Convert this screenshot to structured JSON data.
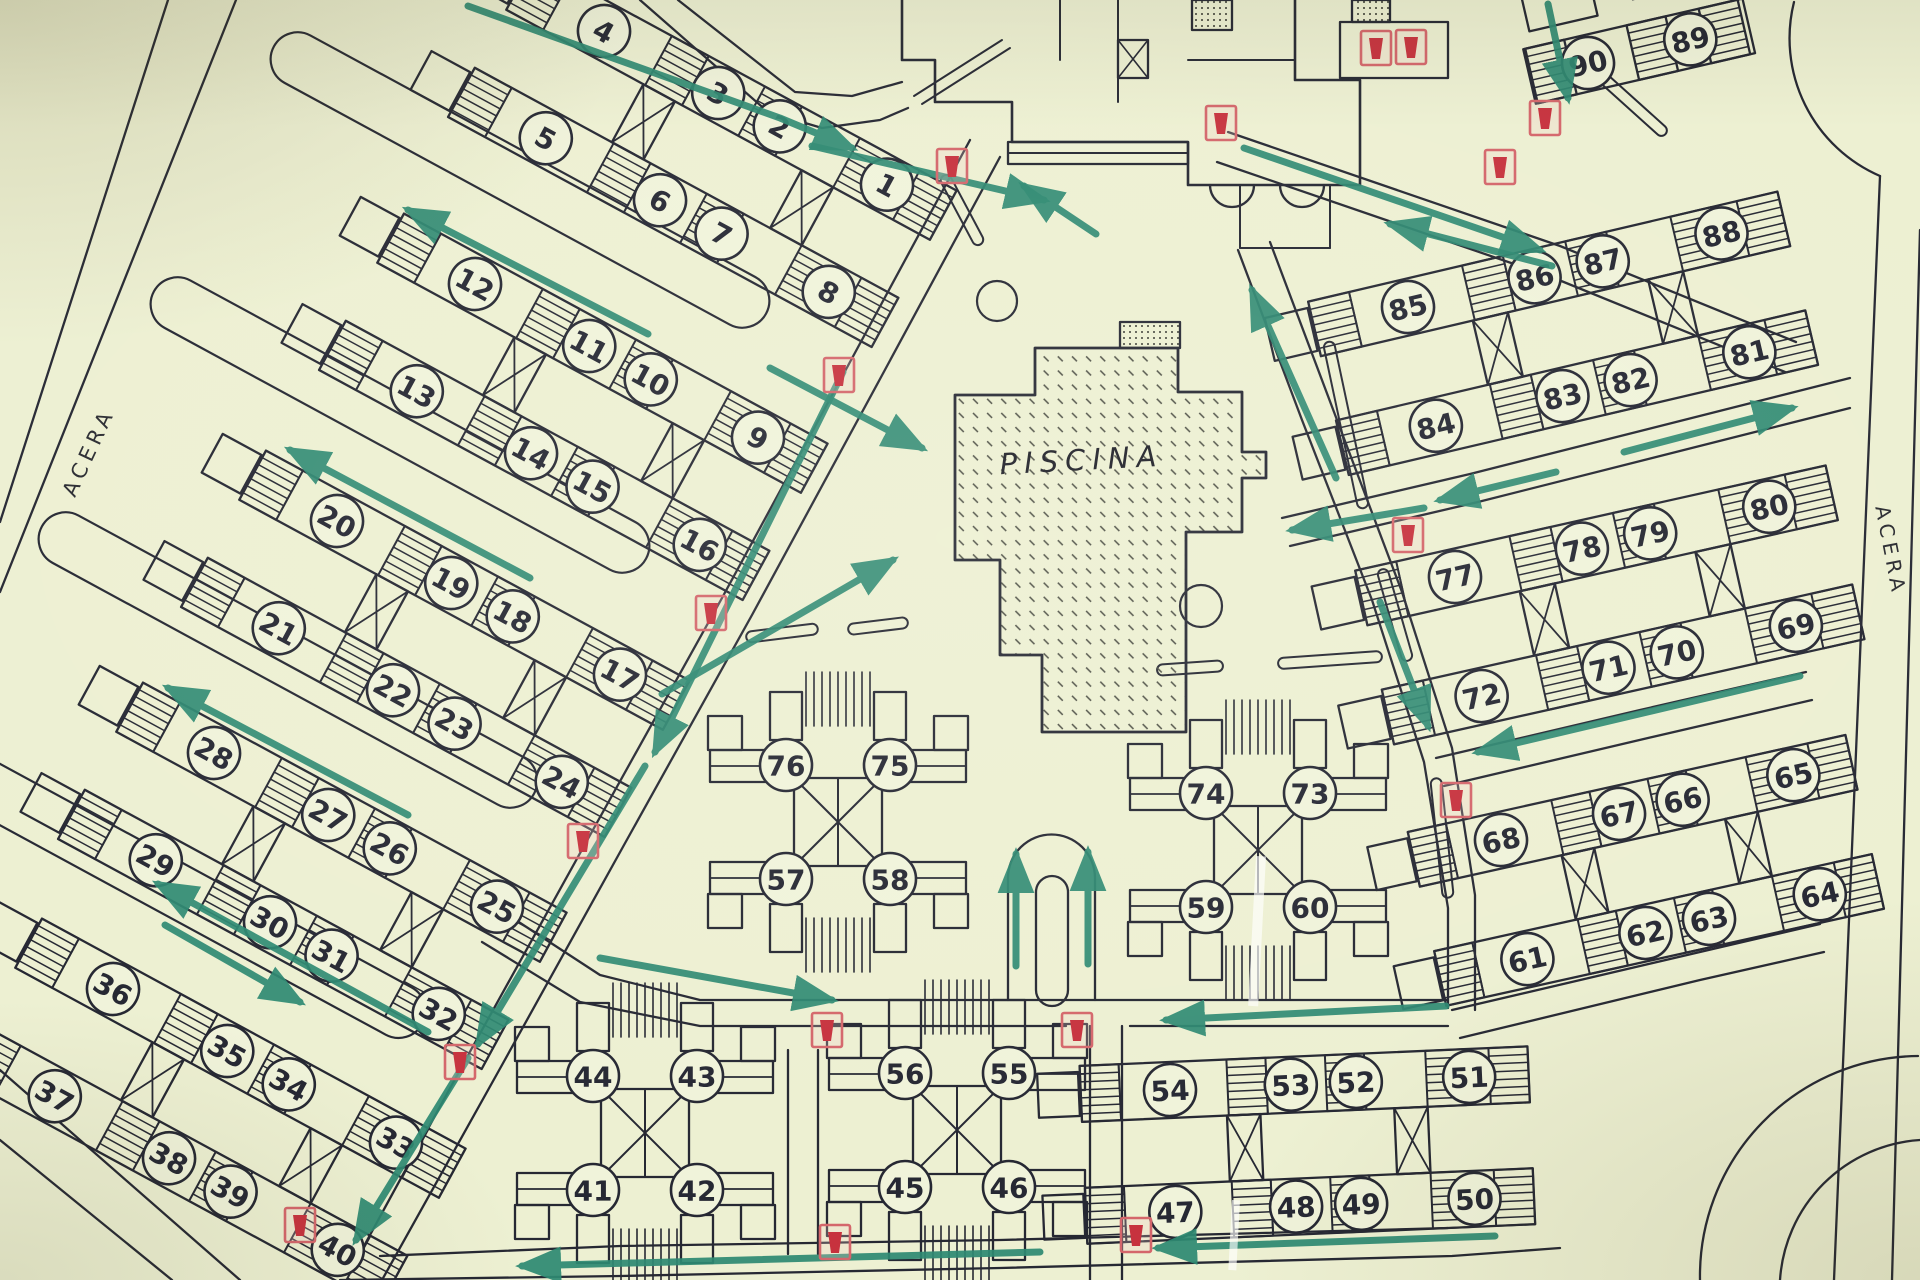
{
  "labels": {
    "piscina": "PISCINA",
    "acera_left": "ACERA",
    "acera_right": "ACERA"
  },
  "colors": {
    "background": "#edf0d2",
    "line": "#262833",
    "circle_fill": "#f0f3da",
    "path_green": "#2e8a72",
    "hydrant_red": "#c7323e",
    "hydrant_frame": "#d4666b"
  },
  "map": {
    "row_geometry": {
      "x0": -96,
      "x1": 386,
      "half": 28,
      "gap": 122,
      "cr": 26,
      "hatch_w": 42,
      "hatches": [
        -96,
        62,
        168,
        276,
        344
      ],
      "divs": [
        -54,
        104,
        210,
        318
      ],
      "braces": [
        60,
        240
      ],
      "brace_w": 36,
      "sx": [
        0,
        130,
        200,
        322
      ],
      "ends": [
        [
          -142,
          -22
        ],
        [
          -142,
          100
        ]
      ]
    },
    "pinwheel_geometry": {
      "sq": 44,
      "cr": 25,
      "cx": 52,
      "cy": 57,
      "comb_x": 32,
      "comb_step": 8,
      "comb_y0": 96,
      "comb_y1": 150
    },
    "row_clusters": [
      {
        "origin": [
          604,
          31
        ],
        "angle": 28.5,
        "top": [
          4,
          3,
          2,
          1
        ],
        "bottom": [
          5,
          6,
          7,
          8
        ]
      },
      {
        "origin": [
          475,
          284
        ],
        "angle": 28.5,
        "top": [
          12,
          11,
          10,
          9
        ],
        "bottom": [
          13,
          14,
          15,
          16
        ]
      },
      {
        "origin": [
          337,
          521
        ],
        "angle": 28.5,
        "top": [
          20,
          19,
          18,
          17
        ],
        "bottom": [
          21,
          22,
          23,
          24
        ]
      },
      {
        "origin": [
          214,
          753
        ],
        "angle": 28.5,
        "top": [
          28,
          27,
          26,
          25
        ],
        "bottom": [
          29,
          30,
          31,
          32
        ]
      },
      {
        "origin": [
          113,
          989
        ],
        "angle": 28.5,
        "top": [
          36,
          35,
          34,
          33
        ],
        "bottom": [
          37,
          38,
          39,
          40
        ]
      },
      {
        "origin": [
          1170,
          1090
        ],
        "angle": -2.5,
        "scale": 0.93,
        "top": [
          54,
          53,
          52,
          51
        ],
        "bottom": [
          47,
          48,
          49,
          50
        ]
      },
      {
        "origin": [
          1501,
          840
        ],
        "angle": -12.5,
        "scale": 0.93,
        "top": [
          68,
          67,
          66,
          65
        ],
        "bottom": [
          61,
          62,
          63,
          64
        ]
      },
      {
        "origin": [
          1455,
          577
        ],
        "angle": -12.6,
        "top": [
          77,
          78,
          79,
          80
        ],
        "bottom": [
          72,
          71,
          70,
          69
        ]
      },
      {
        "origin": [
          1408,
          307
        ],
        "angle": -13.2,
        "top": [
          85,
          86,
          87,
          88
        ],
        "bottom": [
          84,
          83,
          82,
          81
        ]
      },
      {
        "origin": [
          1588,
          63
        ],
        "angle": -13,
        "partial": true,
        "top": [
          90,
          89
        ],
        "bottom": []
      }
    ],
    "pinwheels": [
      {
        "center": [
          838,
          822
        ],
        "top": [
          76,
          75
        ],
        "bottom": [
          57,
          58
        ]
      },
      {
        "center": [
          1258,
          850
        ],
        "top": [
          74,
          73
        ],
        "bottom": [
          59,
          60
        ]
      },
      {
        "center": [
          645,
          1133
        ],
        "top": [
          44,
          43
        ],
        "bottom": [
          41,
          42
        ]
      },
      {
        "center": [
          957,
          1130
        ],
        "top": [
          56,
          55
        ],
        "bottom": [
          45,
          46
        ]
      }
    ],
    "roads": [
      [
        [
          970,
          140
        ],
        [
          850,
          362
        ],
        [
          722,
          598
        ],
        [
          594,
          828
        ],
        [
          472,
          1048
        ],
        [
          352,
          1268
        ]
      ],
      [
        [
          1000,
          157
        ],
        [
          880,
          379
        ],
        [
          752,
          615
        ],
        [
          624,
          845
        ],
        [
          502,
          1065
        ],
        [
          382,
          1280
        ]
      ],
      [
        [
          640,
          0
        ],
        [
          768,
          112
        ],
        [
          822,
          128
        ],
        [
          880,
          120
        ],
        [
          908,
          108
        ]
      ],
      [
        [
          678,
          0
        ],
        [
          795,
          92
        ],
        [
          852,
          96
        ],
        [
          902,
          82
        ]
      ],
      [
        [
          1238,
          250
        ],
        [
          1302,
          420
        ],
        [
          1372,
          600
        ],
        [
          1424,
          762
        ],
        [
          1448,
          908
        ],
        [
          1448,
          1008
        ]
      ],
      [
        [
          1270,
          242
        ],
        [
          1334,
          412
        ],
        [
          1402,
          592
        ],
        [
          1452,
          748
        ],
        [
          1475,
          895
        ],
        [
          1475,
          1010
        ]
      ],
      [
        [
          508,
          915
        ],
        [
          600,
          975
        ],
        [
          700,
          1000
        ],
        [
          1448,
          1000
        ]
      ],
      [
        [
          482,
          942
        ],
        [
          580,
          1002
        ],
        [
          700,
          1026
        ],
        [
          1066,
          1026
        ]
      ],
      [
        [
          1130,
          1026
        ],
        [
          1448,
          1026
        ]
      ],
      [
        [
          1090,
          1026
        ],
        [
          1090,
          1280
        ]
      ],
      [
        [
          1122,
          1026
        ],
        [
          1122,
          1280
        ]
      ],
      [
        [
          1228,
          132
        ],
        [
          1560,
          246
        ],
        [
          1796,
          342
        ]
      ],
      [
        [
          1217,
          162
        ],
        [
          1549,
          276
        ],
        [
          1785,
          372
        ]
      ],
      [
        [
          1282,
          518
        ],
        [
          1470,
          474
        ],
        [
          1850,
          378
        ]
      ],
      [
        [
          1290,
          546
        ],
        [
          1478,
          502
        ],
        [
          1850,
          408
        ]
      ],
      [
        [
          1436,
          758
        ],
        [
          1640,
          710
        ],
        [
          1806,
          672
        ]
      ],
      [
        [
          1444,
          786
        ],
        [
          1648,
          738
        ],
        [
          1812,
          700
        ]
      ],
      [
        [
          1452,
          1010
        ],
        [
          1700,
          952
        ],
        [
          1820,
          924
        ]
      ],
      [
        [
          1460,
          1038
        ],
        [
          1700,
          980
        ],
        [
          1824,
          952
        ]
      ],
      [
        [
          380,
          1256
        ],
        [
          620,
          1246
        ],
        [
          1000,
          1240
        ],
        [
          1448,
          1228
        ]
      ],
      [
        [
          340,
          1280
        ],
        [
          620,
          1276
        ],
        [
          1000,
          1268
        ],
        [
          1452,
          1256
        ],
        [
          1560,
          1248
        ]
      ],
      [
        [
          168,
          0
        ],
        [
          0,
          522
        ]
      ],
      [
        [
          236,
          0
        ],
        [
          0,
          592
        ]
      ],
      [
        [
          0,
          1070
        ],
        [
          240,
          1280
        ]
      ],
      [
        [
          0,
          1140
        ],
        [
          172,
          1280
        ]
      ],
      [
        [
          1880,
          176
        ],
        [
          1834,
          1280
        ]
      ],
      [
        [
          1920,
          230
        ],
        [
          1892,
          1280
        ]
      ],
      [
        [
          788,
          1050
        ],
        [
          788,
          1254
        ]
      ],
      [
        [
          818,
          1050
        ],
        [
          818,
          1254
        ]
      ]
    ],
    "extra_paths": [
      "M 1008 1000 L 1008 878 A 43.5 43.5 0 0 1 1095 878 L 1095 1000",
      "M 1794 2 A 150 150 0 0 0 1880 176",
      "M 1700 1280 A 220 220 0 0 1 1918 1056",
      "M 1780 1280 A 150 150 0 0 1 1920 1140"
    ],
    "island": [
      1036,
      876,
      32,
      130
    ],
    "lanes": [
      {
        "c": [
          520,
          180
        ],
        "a": 28.5,
        "l": 560,
        "w": 54
      },
      {
        "c": [
          400,
          425
        ],
        "a": 28.5,
        "l": 560,
        "w": 54
      },
      {
        "c": [
          288,
          660
        ],
        "a": 28.5,
        "l": 560,
        "w": 54
      },
      {
        "c": [
          185,
          895
        ],
        "a": 28.5,
        "l": 540,
        "w": 54
      }
    ],
    "medians": [
      {
        "c": [
          782,
          633
        ],
        "a": -7,
        "l": 72
      },
      {
        "c": [
          878,
          626
        ],
        "a": -7,
        "l": 60
      },
      {
        "c": [
          1190,
          668
        ],
        "a": -4,
        "l": 66
      },
      {
        "c": [
          1330,
          660
        ],
        "a": -4,
        "l": 104
      },
      {
        "c": [
          962,
          210
        ],
        "a": 62,
        "l": 78
      },
      {
        "c": [
          1346,
          425
        ],
        "a": 78,
        "l": 170
      },
      {
        "c": [
          1395,
          615
        ],
        "a": 74,
        "l": 95
      },
      {
        "c": [
          1442,
          838
        ],
        "a": 84,
        "l": 120
      },
      {
        "c": [
          1632,
          104
        ],
        "a": 42,
        "l": 90
      }
    ],
    "pool": {
      "outline": [
        [
          1035,
          348
        ],
        [
          1178,
          348
        ],
        [
          1178,
          392
        ],
        [
          1242,
          392
        ],
        [
          1242,
          452
        ],
        [
          1266,
          452
        ],
        [
          1266,
          478
        ],
        [
          1242,
          478
        ],
        [
          1242,
          532
        ],
        [
          1186,
          532
        ],
        [
          1186,
          732
        ],
        [
          1042,
          732
        ],
        [
          1042,
          655
        ],
        [
          1000,
          655
        ],
        [
          1000,
          560
        ],
        [
          955,
          560
        ],
        [
          955,
          395
        ],
        [
          1035,
          395
        ]
      ],
      "steps": [
        1120,
        322,
        60,
        26
      ],
      "label_xy": [
        1082,
        470
      ],
      "label_rot": -3
    },
    "building": {
      "outline": "M 902 0 L 902 60 L 935 60 L 935 102 L 1012 102 L 1012 142 L 1188 142 L 1188 185 L 1360 185 L 1360 80 L 1295 80 L 1295 0",
      "inner_lines": [
        [
          [
            1118,
            0
          ],
          [
            1118,
            102
          ]
        ],
        [
          [
            1060,
            0
          ],
          [
            1060,
            60
          ]
        ],
        [
          [
            1188,
            60
          ],
          [
            1295,
            60
          ]
        ],
        [
          [
            1240,
            185
          ],
          [
            1240,
            248
          ]
        ],
        [
          [
            1240,
            248
          ],
          [
            1330,
            248
          ]
        ],
        [
          [
            1330,
            248
          ],
          [
            1330,
            185
          ]
        ],
        [
          [
            914,
            96
          ],
          [
            1002,
            40
          ]
        ],
        [
          [
            922,
            104
          ],
          [
            1010,
            48
          ]
        ]
      ],
      "walkway": [
        1008,
        142,
        180,
        22
      ],
      "squares": [
        {
          "r": [
            1192,
            0,
            40,
            30
          ],
          "fill": "dots"
        },
        {
          "r": [
            1118,
            40,
            30,
            38
          ],
          "fill": "cross"
        },
        {
          "r": [
            1352,
            0,
            38,
            22
          ],
          "fill": "dots"
        }
      ],
      "annex": [
        1340,
        22,
        108,
        56
      ],
      "canopies": [
        [
          1232,
          185,
          22
        ],
        [
          1302,
          185,
          22
        ]
      ]
    },
    "arrows": [
      [
        [
          468,
          6
        ],
        [
          780,
          118
        ],
        [
          852,
          148
        ]
      ],
      [
        [
          812,
          146
        ],
        [
          1044,
          200
        ]
      ],
      [
        [
          770,
          368
        ],
        [
          922,
          448
        ]
      ],
      [
        [
          662,
          694
        ],
        [
          893,
          560
        ]
      ],
      [
        [
          843,
          372
        ],
        [
          655,
          752
        ]
      ],
      [
        [
          645,
          766
        ],
        [
          478,
          1044
        ]
      ],
      [
        [
          468,
          1058
        ],
        [
          356,
          1240
        ]
      ],
      [
        [
          648,
          334
        ],
        [
          408,
          210
        ]
      ],
      [
        [
          530,
          578
        ],
        [
          290,
          450
        ]
      ],
      [
        [
          408,
          815
        ],
        [
          168,
          688
        ]
      ],
      [
        [
          428,
          1032
        ],
        [
          158,
          884
        ]
      ],
      [
        [
          165,
          925
        ],
        [
          300,
          1002
        ]
      ],
      [
        [
          1016,
          966
        ],
        [
          1016,
          854
        ]
      ],
      [
        [
          1088,
          964
        ],
        [
          1088,
          852
        ]
      ],
      [
        [
          600,
          958
        ],
        [
          832,
          1000
        ]
      ],
      [
        [
          1446,
          1006
        ],
        [
          1166,
          1020
        ]
      ],
      [
        [
          1495,
          1236
        ],
        [
          1158,
          1248
        ]
      ],
      [
        [
          1040,
          1252
        ],
        [
          522,
          1266
        ]
      ],
      [
        [
          1336,
          478
        ],
        [
          1252,
          290
        ]
      ],
      [
        [
          1556,
          472
        ],
        [
          1440,
          500
        ]
      ],
      [
        [
          1424,
          508
        ],
        [
          1292,
          530
        ]
      ],
      [
        [
          1624,
          452
        ],
        [
          1792,
          408
        ]
      ],
      [
        [
          1800,
          676
        ],
        [
          1478,
          752
        ]
      ],
      [
        [
          1380,
          602
        ],
        [
          1428,
          726
        ]
      ],
      [
        [
          1244,
          148
        ],
        [
          1540,
          250
        ]
      ],
      [
        [
          1552,
          266
        ],
        [
          1390,
          224
        ]
      ],
      [
        [
          1096,
          234
        ],
        [
          1024,
          186
        ]
      ],
      [
        [
          1548,
          4
        ],
        [
          1568,
          98
        ]
      ]
    ],
    "hydrants": [
      [
        952,
        166
      ],
      [
        839,
        375
      ],
      [
        711,
        613
      ],
      [
        583,
        841
      ],
      [
        460,
        1062
      ],
      [
        300,
        1225
      ],
      [
        827,
        1030
      ],
      [
        835,
        1242
      ],
      [
        1077,
        1030
      ],
      [
        1136,
        1235
      ],
      [
        1456,
        800
      ],
      [
        1408,
        535
      ],
      [
        1500,
        167
      ],
      [
        1376,
        48
      ],
      [
        1411,
        47
      ],
      [
        1221,
        123
      ],
      [
        1545,
        118
      ]
    ],
    "trees": [
      [
        997,
        301,
        20
      ],
      [
        1201,
        606,
        21
      ]
    ],
    "scratches": [
      [
        1256,
        856,
        10,
        150
      ],
      [
        1232,
        1200,
        8,
        70
      ]
    ],
    "label_positions": {
      "acera_left": {
        "xy": [
          95,
          455
        ],
        "rot": -65
      },
      "acera_right": {
        "xy": [
          1884,
          552
        ],
        "rot": 79
      }
    }
  }
}
